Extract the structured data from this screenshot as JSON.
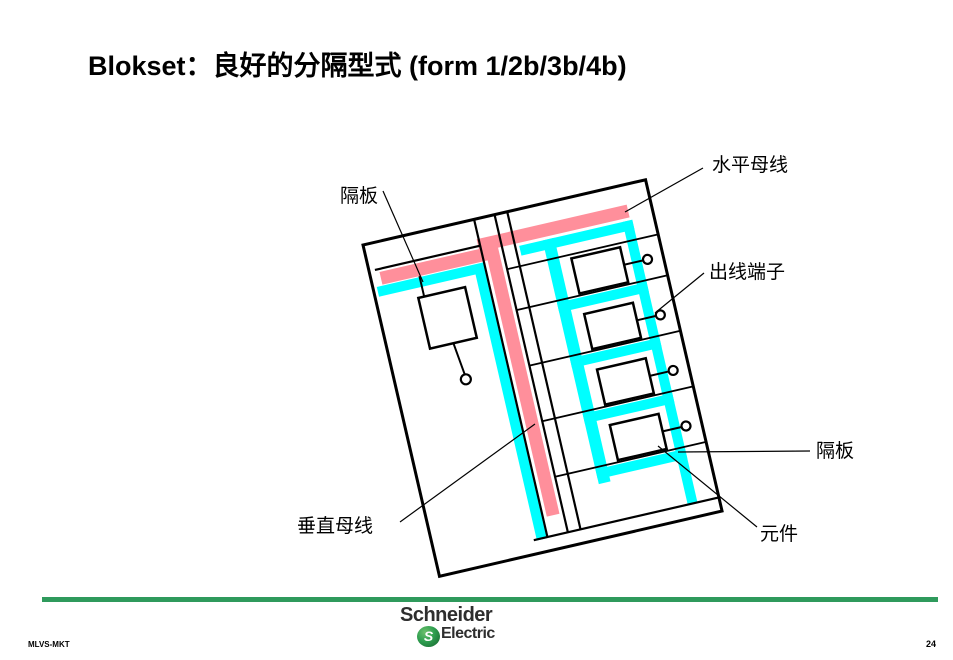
{
  "title": "Blokset：良好的分隔型式 (form 1/2b/3b/4b)",
  "diagram": {
    "labels": {
      "partition_top": "隔板",
      "horizontal_busbar": "水平母线",
      "outgoing_terminal": "出线端子",
      "partition_right": "隔板",
      "component": "元件",
      "vertical_busbar": "垂直母线"
    }
  },
  "colors": {
    "busbar_pink": "#FF8F9B",
    "partition_cyan": "#00FFFF",
    "footer_green": "#2F9A5C",
    "logo_green": "#2E9E4F"
  },
  "footer": {
    "org": "MLVS-MKT",
    "page_number": "24",
    "logo_line1": "Schneider",
    "logo_line2": "Electric",
    "logo_monogram": "S"
  }
}
